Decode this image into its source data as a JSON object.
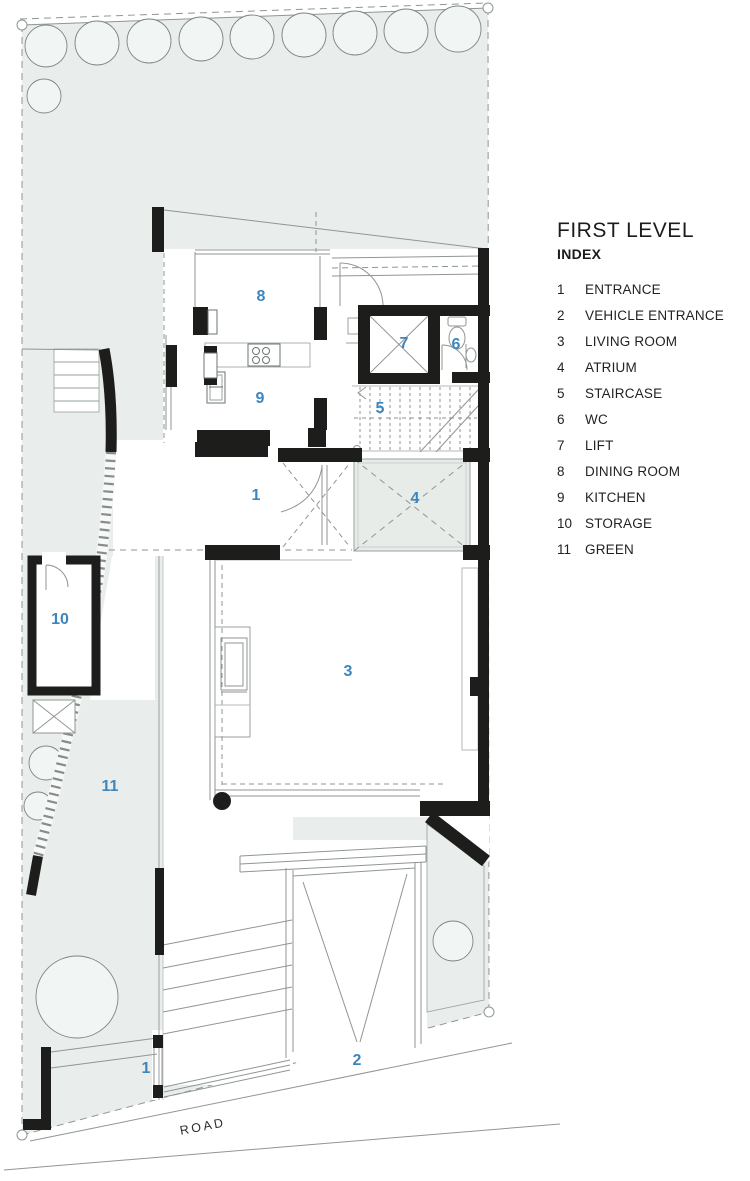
{
  "legend": {
    "title": "FIRST LEVEL",
    "subtitle": "INDEX",
    "items": [
      {
        "num": "1",
        "label": "ENTRANCE"
      },
      {
        "num": "2",
        "label": "VEHICLE ENTRANCE"
      },
      {
        "num": "3",
        "label": "LIVING ROOM"
      },
      {
        "num": "4",
        "label": "ATRIUM"
      },
      {
        "num": "5",
        "label": "STAIRCASE"
      },
      {
        "num": "6",
        "label": "WC"
      },
      {
        "num": "7",
        "label": "LIFT"
      },
      {
        "num": "8",
        "label": "DINING ROOM"
      },
      {
        "num": "9",
        "label": "KITCHEN"
      },
      {
        "num": "10",
        "label": "STORAGE"
      },
      {
        "num": "11",
        "label": "GREEN"
      }
    ]
  },
  "plan": {
    "road_label": "ROAD",
    "room_labels": [
      {
        "num": "8",
        "room": "dining-room",
        "x": 261,
        "y": 297
      },
      {
        "num": "9",
        "room": "kitchen",
        "x": 260,
        "y": 399
      },
      {
        "num": "7",
        "room": "lift",
        "x": 404,
        "y": 344
      },
      {
        "num": "6",
        "room": "wc",
        "x": 456,
        "y": 345
      },
      {
        "num": "5",
        "room": "staircase",
        "x": 380,
        "y": 409
      },
      {
        "num": "1",
        "room": "entrance",
        "x": 256,
        "y": 496
      },
      {
        "num": "4",
        "room": "atrium",
        "x": 415,
        "y": 499
      },
      {
        "num": "3",
        "room": "living-room",
        "x": 348,
        "y": 672
      },
      {
        "num": "10",
        "room": "storage",
        "x": 60,
        "y": 620
      },
      {
        "num": "11",
        "room": "green",
        "x": 110,
        "y": 787
      },
      {
        "num": "2",
        "room": "vehicle-entrance",
        "x": 357,
        "y": 1061
      },
      {
        "num": "1",
        "room": "entrance-gate",
        "x": 146,
        "y": 1069
      }
    ],
    "colors": {
      "accent_blue": "#3d86bd",
      "site_green": "#e9edeb",
      "wall_black": "#1d1d1b",
      "line_gray": "#8f9693"
    }
  }
}
